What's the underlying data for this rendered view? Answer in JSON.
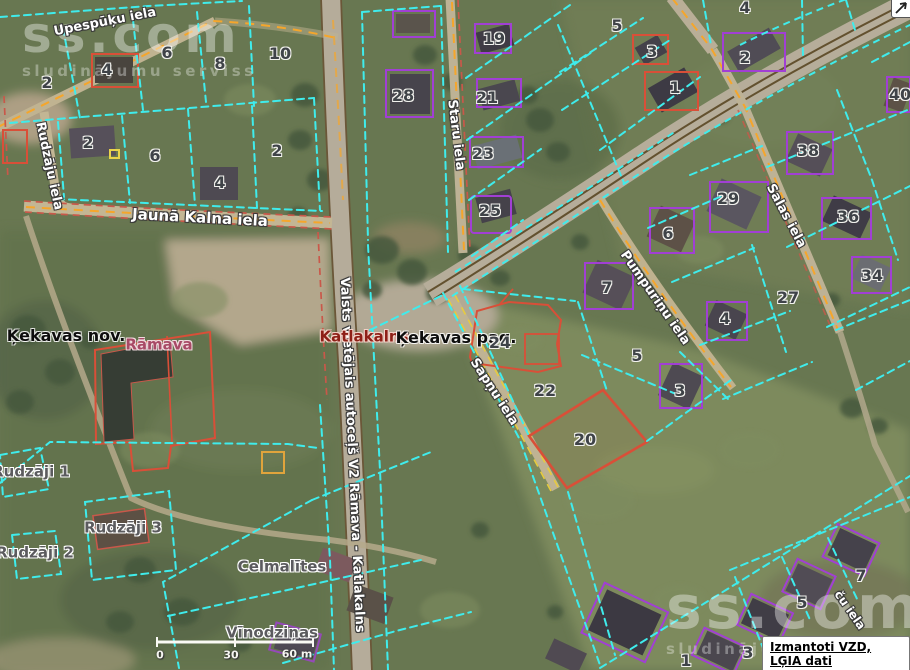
{
  "map": {
    "region_names": {
      "municipality": "Ķekavas nov.",
      "parish": "Ķekavas pag.",
      "village": "Katlakalns",
      "locality": "Rāmava"
    },
    "place_labels": [
      {
        "text": "Ķekavas nov.",
        "x": 66,
        "y": 336,
        "size": 16,
        "color": "#0d0d0d"
      },
      {
        "text": "Katlakalns",
        "x": 364,
        "y": 337,
        "size": 15,
        "color": "#8e2017",
        "halo": "#f3d2c8"
      },
      {
        "text": "Ķekavas pag.",
        "x": 456,
        "y": 338,
        "size": 16,
        "color": "#0d0d0d"
      },
      {
        "text": "Rāmava",
        "x": 159,
        "y": 345,
        "size": 15,
        "color": "#a84a66",
        "halo": "#f0dade"
      }
    ],
    "farm_labels": [
      {
        "text": "Rudzāji 1",
        "x": 31,
        "y": 472
      },
      {
        "text": "Rudzāji 2",
        "x": 35,
        "y": 553
      },
      {
        "text": "Rudzāji 3",
        "x": 123,
        "y": 528
      },
      {
        "text": "Celmalītes",
        "x": 282,
        "y": 567
      },
      {
        "text": "Vīnodziņas",
        "x": 272,
        "y": 633
      }
    ],
    "street_labels": [
      {
        "text": "Upespūķu iela",
        "x": 105,
        "y": 22,
        "rot": -11,
        "size": 13
      },
      {
        "text": "Rudzāju iela",
        "x": 49,
        "y": 166,
        "rot": 78,
        "size": 13
      },
      {
        "text": "Jaunā Kalna iela",
        "x": 200,
        "y": 218,
        "rot": 3,
        "size": 15
      },
      {
        "text": "Valsts vietējais autoceļš V2 Rāmava - Katlakalns",
        "x": 352,
        "y": 455,
        "rot": 87.5,
        "size": 13
      },
      {
        "text": "Staru iela",
        "x": 456,
        "y": 135,
        "rot": 83,
        "size": 13
      },
      {
        "text": "Sapņu iela",
        "x": 494,
        "y": 392,
        "rot": 57,
        "size": 13
      },
      {
        "text": "Pumpuriņu iela",
        "x": 655,
        "y": 298,
        "rot": 55,
        "size": 13
      },
      {
        "text": "Salas iela",
        "x": 786,
        "y": 216,
        "rot": 62,
        "size": 13
      },
      {
        "text": "ču iela",
        "x": 850,
        "y": 610,
        "rot": 55,
        "size": 12
      }
    ],
    "parcel_numbers": [
      {
        "n": "2",
        "x": 47,
        "y": 83
      },
      {
        "n": "4",
        "x": 107,
        "y": 70
      },
      {
        "n": "6",
        "x": 167,
        "y": 53
      },
      {
        "n": "8",
        "x": 220,
        "y": 64
      },
      {
        "n": "10",
        "x": 280,
        "y": 54
      },
      {
        "n": "2",
        "x": 88,
        "y": 143
      },
      {
        "n": "6",
        "x": 155,
        "y": 156
      },
      {
        "n": "4",
        "x": 220,
        "y": 183
      },
      {
        "n": "2",
        "x": 277,
        "y": 151
      },
      {
        "n": "28",
        "x": 403,
        "y": 96
      },
      {
        "n": "19",
        "x": 494,
        "y": 39
      },
      {
        "n": "21",
        "x": 487,
        "y": 98
      },
      {
        "n": "23",
        "x": 483,
        "y": 154
      },
      {
        "n": "25",
        "x": 490,
        "y": 211
      },
      {
        "n": "5",
        "x": 617,
        "y": 26
      },
      {
        "n": "3",
        "x": 652,
        "y": 52
      },
      {
        "n": "1",
        "x": 675,
        "y": 88
      },
      {
        "n": "4",
        "x": 745,
        "y": 8
      },
      {
        "n": "2",
        "x": 745,
        "y": 58
      },
      {
        "n": "40",
        "x": 900,
        "y": 95
      },
      {
        "n": "38",
        "x": 808,
        "y": 151
      },
      {
        "n": "29",
        "x": 728,
        "y": 199
      },
      {
        "n": "36",
        "x": 848,
        "y": 217
      },
      {
        "n": "34",
        "x": 872,
        "y": 276
      },
      {
        "n": "27",
        "x": 788,
        "y": 298
      },
      {
        "n": "6",
        "x": 668,
        "y": 234
      },
      {
        "n": "7",
        "x": 607,
        "y": 288
      },
      {
        "n": "4",
        "x": 725,
        "y": 319
      },
      {
        "n": "24",
        "x": 500,
        "y": 343
      },
      {
        "n": "22",
        "x": 545,
        "y": 391
      },
      {
        "n": "5",
        "x": 637,
        "y": 356
      },
      {
        "n": "3",
        "x": 680,
        "y": 391
      },
      {
        "n": "20",
        "x": 585,
        "y": 440
      },
      {
        "n": "7",
        "x": 861,
        "y": 576
      },
      {
        "n": "5",
        "x": 802,
        "y": 603
      },
      {
        "n": "3",
        "x": 748,
        "y": 653
      },
      {
        "n": "1",
        "x": 686,
        "y": 661
      }
    ],
    "highlighted_parcel": {
      "number": "20"
    },
    "scale_bar": {
      "labels": [
        {
          "text": "0",
          "x": 160,
          "y": 655
        },
        {
          "text": "30",
          "x": 231,
          "y": 655
        },
        {
          "text": "60 m",
          "x": 297,
          "y": 654
        }
      ]
    },
    "watermark": {
      "line1": "ss.com",
      "line2": "sludinājumu serviss"
    },
    "attribution": {
      "text": "Izmantoti VZD, LĢIA dati"
    },
    "colors": {
      "cadastral_line": "#3fecec",
      "highlight_parcel": "#d94f38",
      "building_outline": "#a13fd4",
      "road_dash_orange": "#f5a62b",
      "street_dash_yellow": "#e7cb3e"
    }
  }
}
